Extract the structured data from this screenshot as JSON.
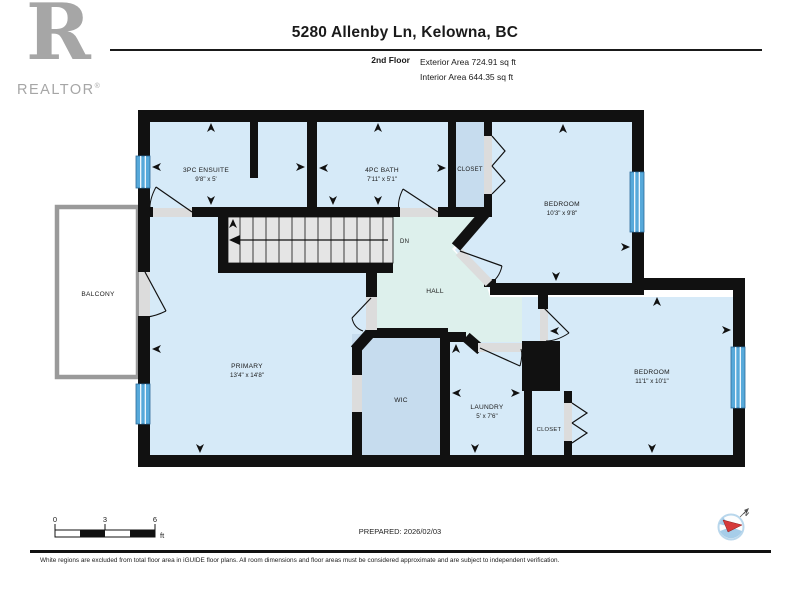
{
  "header": {
    "title": "5280 Allenby Ln, Kelowna, BC",
    "floor_label": "2nd Floor",
    "exterior_area": "Exterior Area 724.91 sq ft",
    "interior_area": "Interior Area 644.35 sq ft"
  },
  "logo": {
    "letter": "R",
    "brand": "REALTOR",
    "registered": "®"
  },
  "plan": {
    "ensuite": {
      "name": "3PC ENSUITE",
      "dims": "9'8\" x 5'"
    },
    "bath": {
      "name": "4PC BATH",
      "dims": "7'11\" x 5'1\""
    },
    "closet_top": {
      "name": "CLOSET"
    },
    "bedroom1": {
      "name": "BEDROOM",
      "dims": "10'3\" x 9'8\""
    },
    "balcony": {
      "name": "BALCONY"
    },
    "primary": {
      "name": "PRIMARY",
      "dims": "13'4\" x 14'8\""
    },
    "hall": {
      "name": "HALL"
    },
    "stairs": {
      "dn_label": "DN"
    },
    "wic": {
      "name": "WIC"
    },
    "laundry": {
      "name": "LAUNDRY",
      "dims": "5' x 7'6\""
    },
    "closet_bottom": {
      "name": "CLOSET"
    },
    "bedroom2": {
      "name": "BEDROOM",
      "dims": "11'1\" x 10'1\""
    }
  },
  "scale_bar": {
    "ticks": [
      "0",
      "3",
      "6"
    ],
    "unit": "ft"
  },
  "compass": {
    "north_label": "N"
  },
  "footer": {
    "prepared": "PREPARED: 2026/02/03",
    "disclaimer": "White regions are excluded from total floor area in iGUIDE floor plans. All room dimensions and floor areas must be considered approximate and are subject to independent verification."
  },
  "colors": {
    "floor_blue": "#d6eaf8",
    "closet_blue": "#c6dcee",
    "hall_teal": "#ddf0ec",
    "wall_black": "#111111",
    "window_blue": "#57a9da",
    "logo_grey": "#a6a6a6",
    "balcony_grey": "#9a9a9a",
    "compass_red": "#d63a3a"
  }
}
